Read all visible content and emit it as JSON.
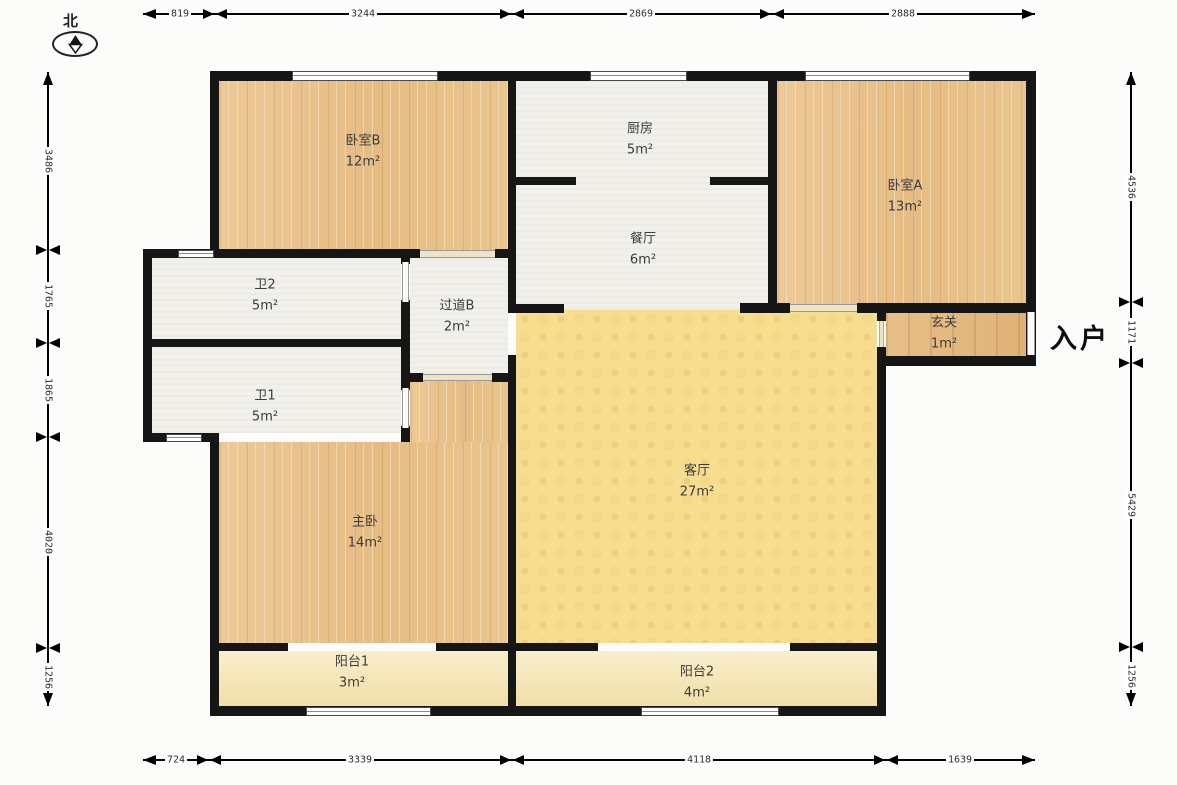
{
  "compass": {
    "label": "北"
  },
  "entrance_label": "入户",
  "rooms": [
    {
      "name": "卧室B",
      "area": "12m²"
    },
    {
      "name": "厨房",
      "area": "5m²"
    },
    {
      "name": "卧室A",
      "area": "13m²"
    },
    {
      "name": "餐厅",
      "area": "6m²"
    },
    {
      "name": "卫2",
      "area": "5m²"
    },
    {
      "name": "过道B",
      "area": "2m²"
    },
    {
      "name": "玄关",
      "area": "1m²"
    },
    {
      "name": "卫1",
      "area": "5m²"
    },
    {
      "name": "客厅",
      "area": "27m²"
    },
    {
      "name": "主卧",
      "area": "14m²"
    },
    {
      "name": "阳台1",
      "area": "3m²"
    },
    {
      "name": "阳台2",
      "area": "4m²"
    }
  ],
  "dimensions": {
    "top": [
      "819",
      "3244",
      "2869",
      "2888"
    ],
    "bottom": [
      "724",
      "3339",
      "4118",
      "1639"
    ],
    "left": [
      "3486",
      "1765",
      "1865",
      "4020",
      "1256"
    ],
    "right": [
      "4536",
      "1171",
      "5429",
      "1256"
    ]
  },
  "colors": {
    "wall": "#161616",
    "wood_floor": "#ebc792",
    "foyer_floor": "#e4ba81",
    "tile_floor": "#f2f0ea",
    "living_floor": "#f7dd90",
    "balcony_floor": "#f5e6b8"
  }
}
